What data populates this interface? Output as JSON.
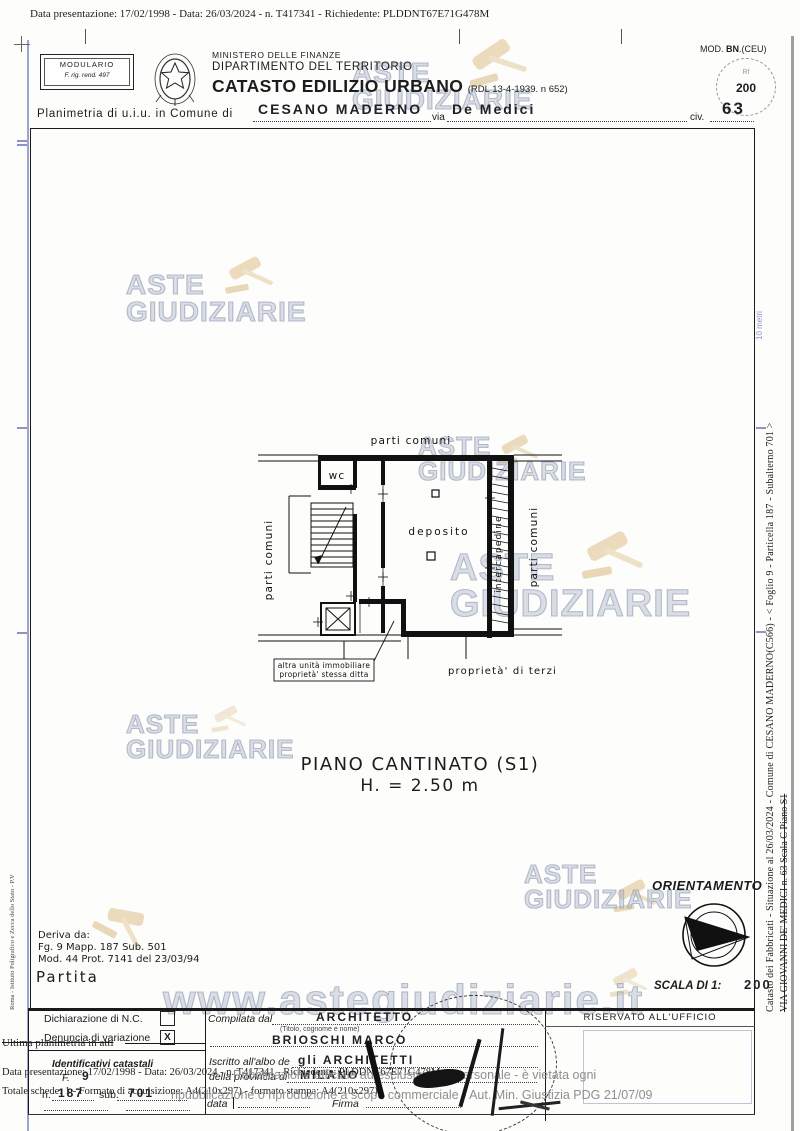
{
  "colors": {
    "watermark": "#aeb6c8",
    "gavel": "#e7d3ad",
    "margin_blue": "#8b93c9",
    "overlay_gray": "#8f8f8f"
  },
  "top": {
    "presentation_line": "Data presentazione: 17/02/1998 - Data: 26/03/2024 - n. T417341 - Richiedente: PLDDNT67E71G478M"
  },
  "header": {
    "modulario_title": "MODULARIO",
    "modulario_sub": "F. rig. rend. 497",
    "ministry": "MINISTERO DELLE FINANZE",
    "department": "DIPARTIMENTO DEL TERRITORIO",
    "title": "CATASTO EDILIZIO URBANO",
    "title_ref": "(RDL 13-4-1939. n 652)",
    "mod_label": "MOD.",
    "mod_value": "BN",
    "mod_suffix": ".(CEU)",
    "stamp_small": "Rf",
    "stamp_value": "200"
  },
  "address": {
    "label": "Planimetria di u.i.u. in Comune di",
    "comune": "CESANO MADERNO",
    "via_label": "via",
    "via": "De Medici",
    "civ_label": "civ.",
    "civ": "63"
  },
  "watermark": {
    "line1": "ASTE",
    "line2": "GIUDIZIARIE",
    "url": "www.astegiudiziarie.it"
  },
  "plan": {
    "parti_comuni": "parti comuni",
    "wc": "wc",
    "deposito": "deposito",
    "intercapedine": "intercapedine",
    "altra_unita_1": "altra unità immobiliare",
    "altra_unita_2": "proprietà' stessa ditta",
    "proprieta_terzi": "proprietà' di terzi",
    "floor_title": "PIANO CANTINATO (S1)",
    "floor_height": "H. = 2.50 m",
    "scale_note": "10 metri"
  },
  "deriva": {
    "title": "Deriva da:",
    "line1": "Fg. 9 Mapp. 187 Sub. 501",
    "line2": "Mod. 44 Prot. 7141 del 23/03/94",
    "partita": "Partita"
  },
  "orient": {
    "title": "ORIENTAMENTO",
    "scala_label": "SCALA DI 1:",
    "scala_value": "200"
  },
  "form": {
    "dichiarazione": "Dichiarazione di N.C.",
    "dichiarazione_mark": "",
    "denuncia": "Denuncia di variazione",
    "denuncia_mark": "X",
    "identificativi": "Identificativi catastali",
    "f_label": "F.",
    "f_value": "9",
    "n_label": "n.",
    "n_value": "187",
    "sub_label": "sub.",
    "sub_value": "701",
    "compilata_label": "Compilata dal",
    "compilata_value": "ARCHITETTO",
    "titolo_note": "(Titolo, cognome e nome)",
    "nome_value": "BRIOSCHI MARCO",
    "iscritto_label": "Iscritto all'albo de",
    "iscritto_value": "gli ARCHITETTI",
    "provincia_label": "della provincia di",
    "provincia_value": "MILANO",
    "data_label": "data",
    "firma_label": "Firma",
    "riservato": "RISERVATO ALL'UFFICIO"
  },
  "overlay": {
    "ultima": "Ultima planimetria in atti",
    "dup_line1": "Data presentazione: 17/02/1998 - Data: 26/03/2024 - n. T417341 - Richiedente: PLDDNT67E71G478M",
    "dup_line2": "Totale schede: 1 - Formato di acquisizione: A4(210x297) - formato stampa: A4(210x297)",
    "vietata1": "Pubblicazione ufficiale ad esclusivo uso personale - è vietata ogni",
    "vietata2": "ripubblicazione o riproduzione a scopo commerciale - Aut. Min. Giustizia PDG 21/07/09"
  },
  "margins": {
    "left_vertical": "Roma - Istituto Poligrafico e Zecca dello Stato - P.V",
    "right_line1": "Catasto dei Fabbricati - Situazione al 26/03/2024 - Comune di CESANO MADERNO(C566) - < Foglio 9 - Particella 187 - Subalterno 701 >",
    "right_line2": "VIA GIOVANNI DE' MEDICI n. 63  Scala C Piano S1"
  }
}
